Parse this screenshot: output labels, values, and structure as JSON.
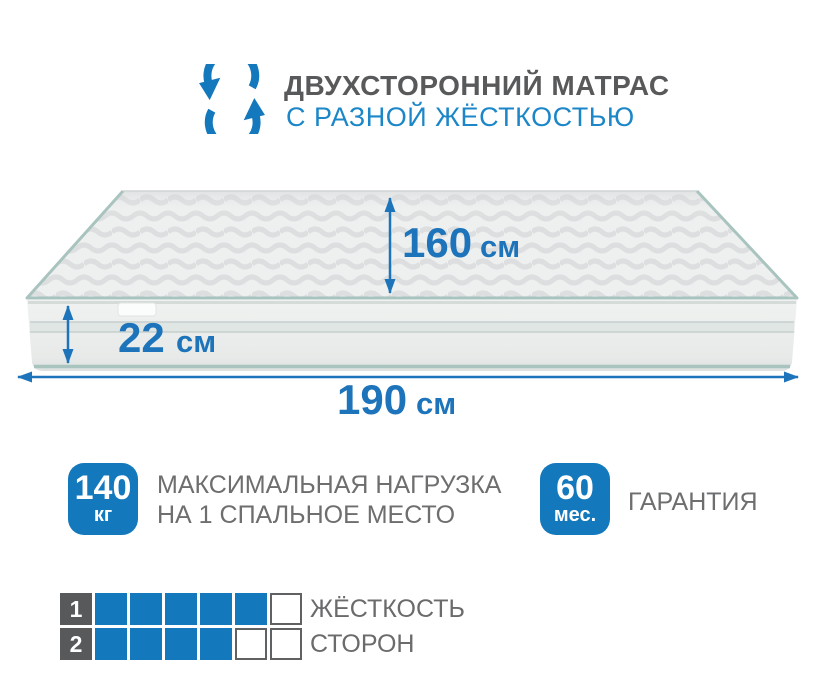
{
  "header": {
    "icon": "rotate-arrows-icon",
    "title": "ДВУХСТОРОННИЙ МАТРАС",
    "subtitle": "С РАЗНОЙ ЖЁСТКОСТЬЮ"
  },
  "dimensions": {
    "depth": {
      "value": "160",
      "unit": "см"
    },
    "height": {
      "value": "22",
      "unit": "см"
    },
    "width": {
      "value": "190",
      "unit": "см"
    }
  },
  "features": [
    {
      "badge_value": "140",
      "badge_unit": "кг",
      "label_line1": "МАКСИМАЛЬНАЯ НАГРУЗКА",
      "label_line2": "НА 1 СПАЛЬНОЕ МЕСТО"
    },
    {
      "badge_value": "60",
      "badge_unit": "мес.",
      "label_line1": "ГАРАНТИЯ"
    }
  ],
  "firmness": {
    "rows": [
      {
        "number": "1",
        "filled": 5,
        "empty": 1,
        "label": "ЖЁСТКОСТЬ"
      },
      {
        "number": "2",
        "filled": 4,
        "empty": 2,
        "label": "СТОРОН"
      }
    ]
  },
  "colors": {
    "accent_blue": "#1478bc",
    "dimension_blue": "#1d74ba",
    "subtitle_blue": "#1b86c8",
    "title_gray": "#58595b",
    "text_gray": "#6d6e70",
    "scale_square_gray": "#58595b",
    "mattress_piping": "#a9c4bf",
    "mattress_side": "#e9ecea",
    "mattress_top": "#eeefef"
  }
}
